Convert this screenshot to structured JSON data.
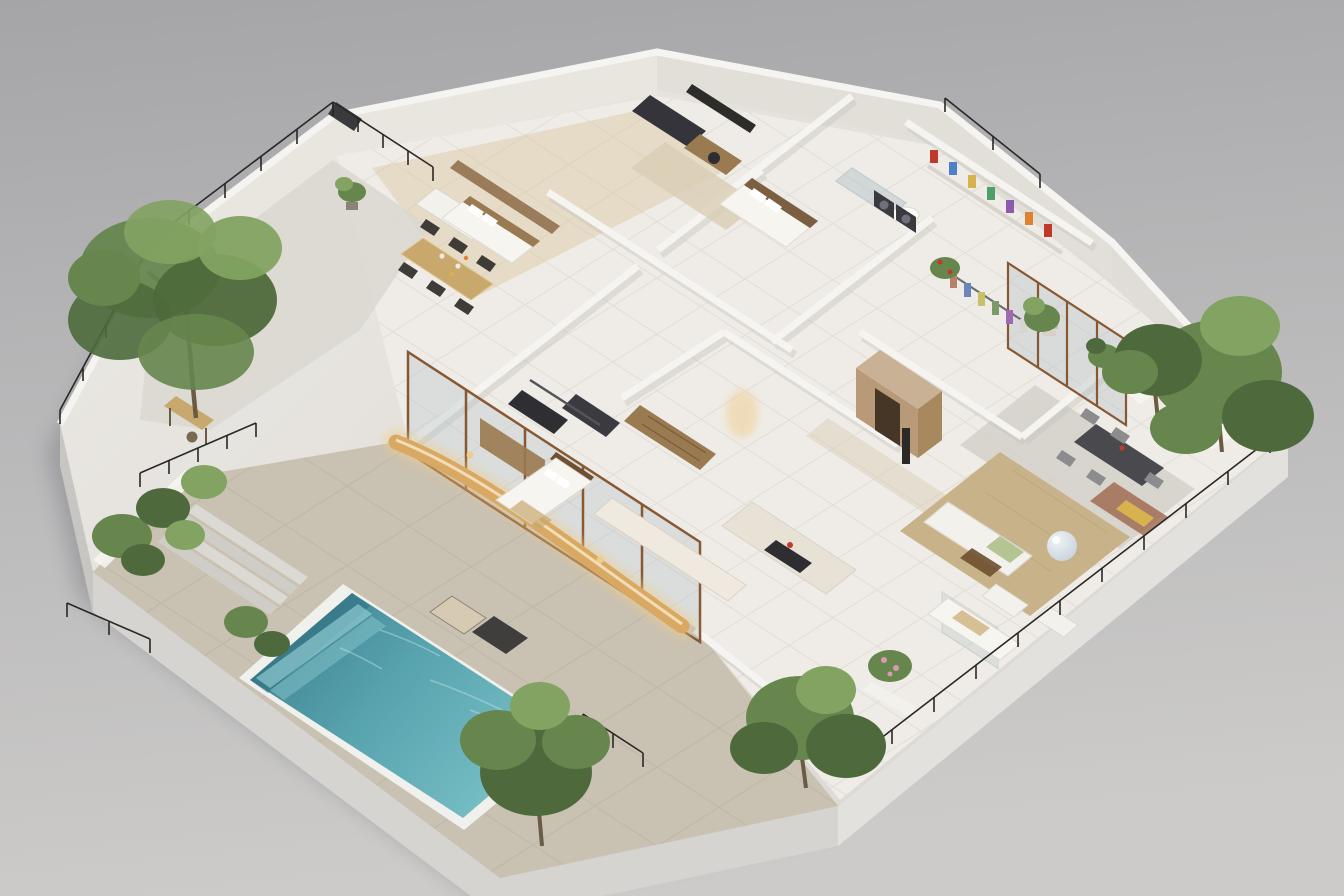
{
  "scene": {
    "type": "isometric-architectural-render",
    "description": "Photorealistic cutaway axonometric model of a single-storey residence with a teal swimming pool on a stone deck, planted terraces, black metal railings and fully furnished rooms, presented on a plain grey studio backdrop.",
    "objects": [
      "swimming pool",
      "stone pool deck",
      "sun loungers",
      "garden planters",
      "large terrace tree",
      "outdoor staircase",
      "curved illuminated bar counter",
      "dining table with chairs",
      "kitchen with island",
      "home gym",
      "master bedroom",
      "guest bedroom",
      "home office",
      "bathroom",
      "laundry machines",
      "colourful storage shelves",
      "walk-in wardrobe",
      "living room with white sofas",
      "balloon sculpture",
      "outdoor dining terrace",
      "balcony garden",
      "entry vestibule",
      "perimeter railings"
    ]
  },
  "palette": {
    "background_top": "#a5a5a8",
    "background_mid": "#bcbbbc",
    "background_bottom": "#cccbc9",
    "shadow": "#50505a",
    "base_top": "#ebe9e5",
    "base_top_deep": "#ddd9d4",
    "base_side_left": "#c7c6c3",
    "base_side_front": "#d5d4d1",
    "base_side_right": "#e2e1de",
    "wall": "#f6f4f0",
    "wall_inner": "#e9e6e0",
    "wall_inner_dark": "#e2dfd8",
    "wall_shadow": "#c6c2bb",
    "deck": "#c9c1b2",
    "deck_line": "#b7afa0",
    "pool_coping": "#f0f0ed",
    "pool_deep": "#2e6e7e",
    "pool_dark": "#3e7e8e",
    "pool_mid": "#57a3ae",
    "pool_light": "#7cc2c8",
    "pool_step": "#8fcbd0",
    "ripple": "#cfeaea",
    "foliage_dark": "#4e6a3c",
    "foliage_mid": "#66864e",
    "foliage_light": "#82a362",
    "trunk": "#6b5a44",
    "wood_dark": "#6e4f30",
    "wood_mid": "#9a7a50",
    "wood_light": "#c9a86e",
    "panel_wood": "#9a7c5a",
    "glass": "#b7c4c9",
    "frame": "#875832",
    "railing": "#2a2825",
    "rug_jute": "#c7b289",
    "rug_tan": "#d9cdb4",
    "sofa": "#f3f1ec",
    "bed": "#f7f5f0",
    "dark_furniture": "#35343a",
    "appliance": "#3a3a3e",
    "counter": "#efe9df",
    "island": "#e8e2d6",
    "amber": "#d9a964",
    "amber_glow": "#f0cc8a",
    "tile_line": "#dcd8d1",
    "floor": "#efece7",
    "terrace_stone": "#d3d0c9",
    "stone_light": "#dad7d0",
    "entry_tan": "#b89a78",
    "entry_roof": "#c9b196",
    "entry_side": "#a8895f",
    "accent_red": "#c0392b",
    "accent_orange": "#e08030",
    "accent_pink": "#d89ab0",
    "accent_yellow": "#d8b24e",
    "accent_blue": "#4f7fc9",
    "accent_green": "#4da06a",
    "accent_purple": "#8a5ab0",
    "accent_silver": "#c3ced8",
    "lounger_light": "#d6cbb2",
    "lounger_dark": "#3f3e3c"
  }
}
